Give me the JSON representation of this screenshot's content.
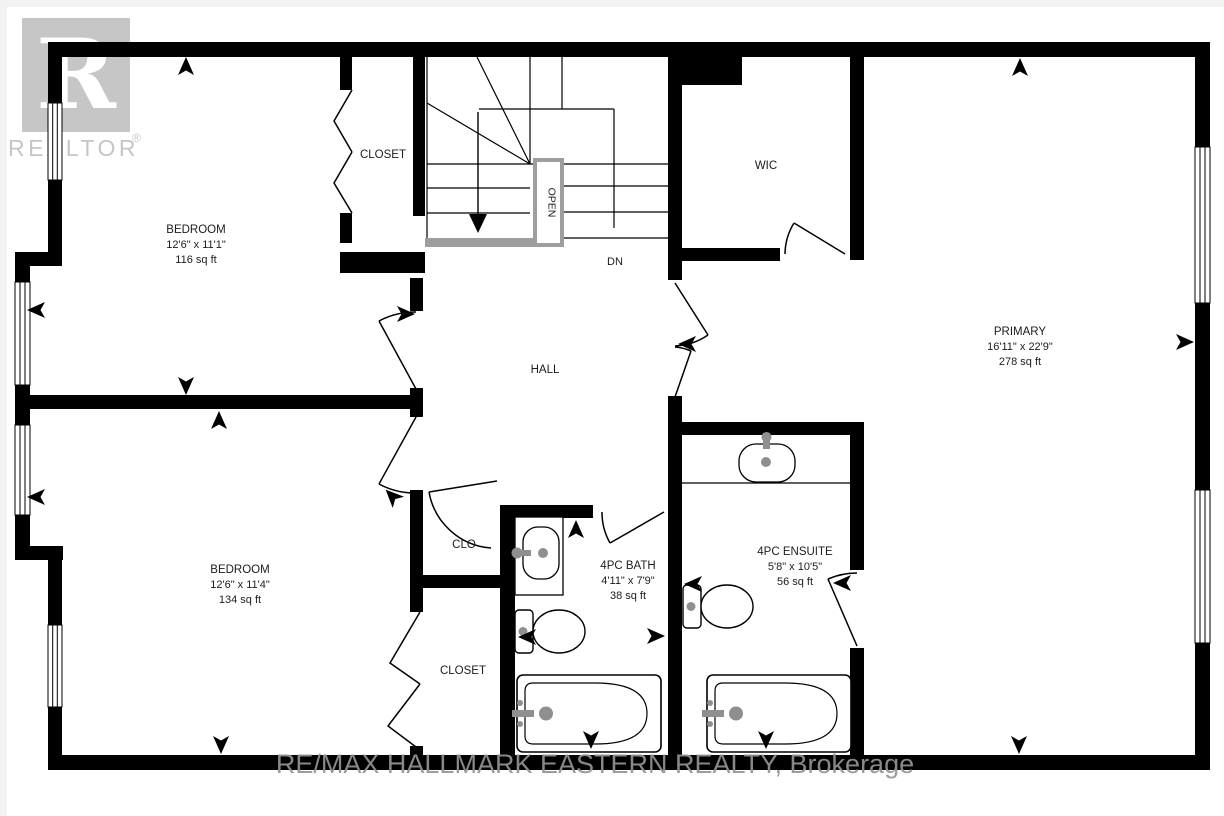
{
  "floorplan": {
    "rooms": [
      {
        "name": "BEDROOM",
        "dimensions": "12'6\" x 11'1\"",
        "area": "116 sq ft"
      },
      {
        "name": "CLOSET"
      },
      {
        "name": "WIC"
      },
      {
        "name": "PRIMARY",
        "dimensions": "16'11\" x 22'9\"",
        "area": "278 sq ft"
      },
      {
        "name": "HALL"
      },
      {
        "name": "BEDROOM",
        "dimensions": "12'6\" x 11'4\"",
        "area": "134 sq ft"
      },
      {
        "name": "CLO"
      },
      {
        "name": "CLOSET"
      },
      {
        "name": "4PC BATH",
        "dimensions": "4'11\" x 7'9\"",
        "area": "38 sq ft"
      },
      {
        "name": "4PC ENSUITE",
        "dimensions": "5'8\" x 10'5\"",
        "area": "56 sq ft"
      }
    ],
    "stairs": {
      "open_label": "OPEN",
      "down_label": "DN"
    },
    "watermarks": {
      "logo_letter": "R",
      "logo_text": "REALTOR",
      "registered": "®",
      "brokerage": "RE/MAX HALLMARK EASTERN REALTY, Brokerage"
    },
    "colors": {
      "wall": "#000000",
      "stair_gray": "#9e9e9e",
      "fixture_gray": "#8f8f8f",
      "logo_gray": "#c6c6c6",
      "brokerage_gray": "#949494"
    }
  }
}
